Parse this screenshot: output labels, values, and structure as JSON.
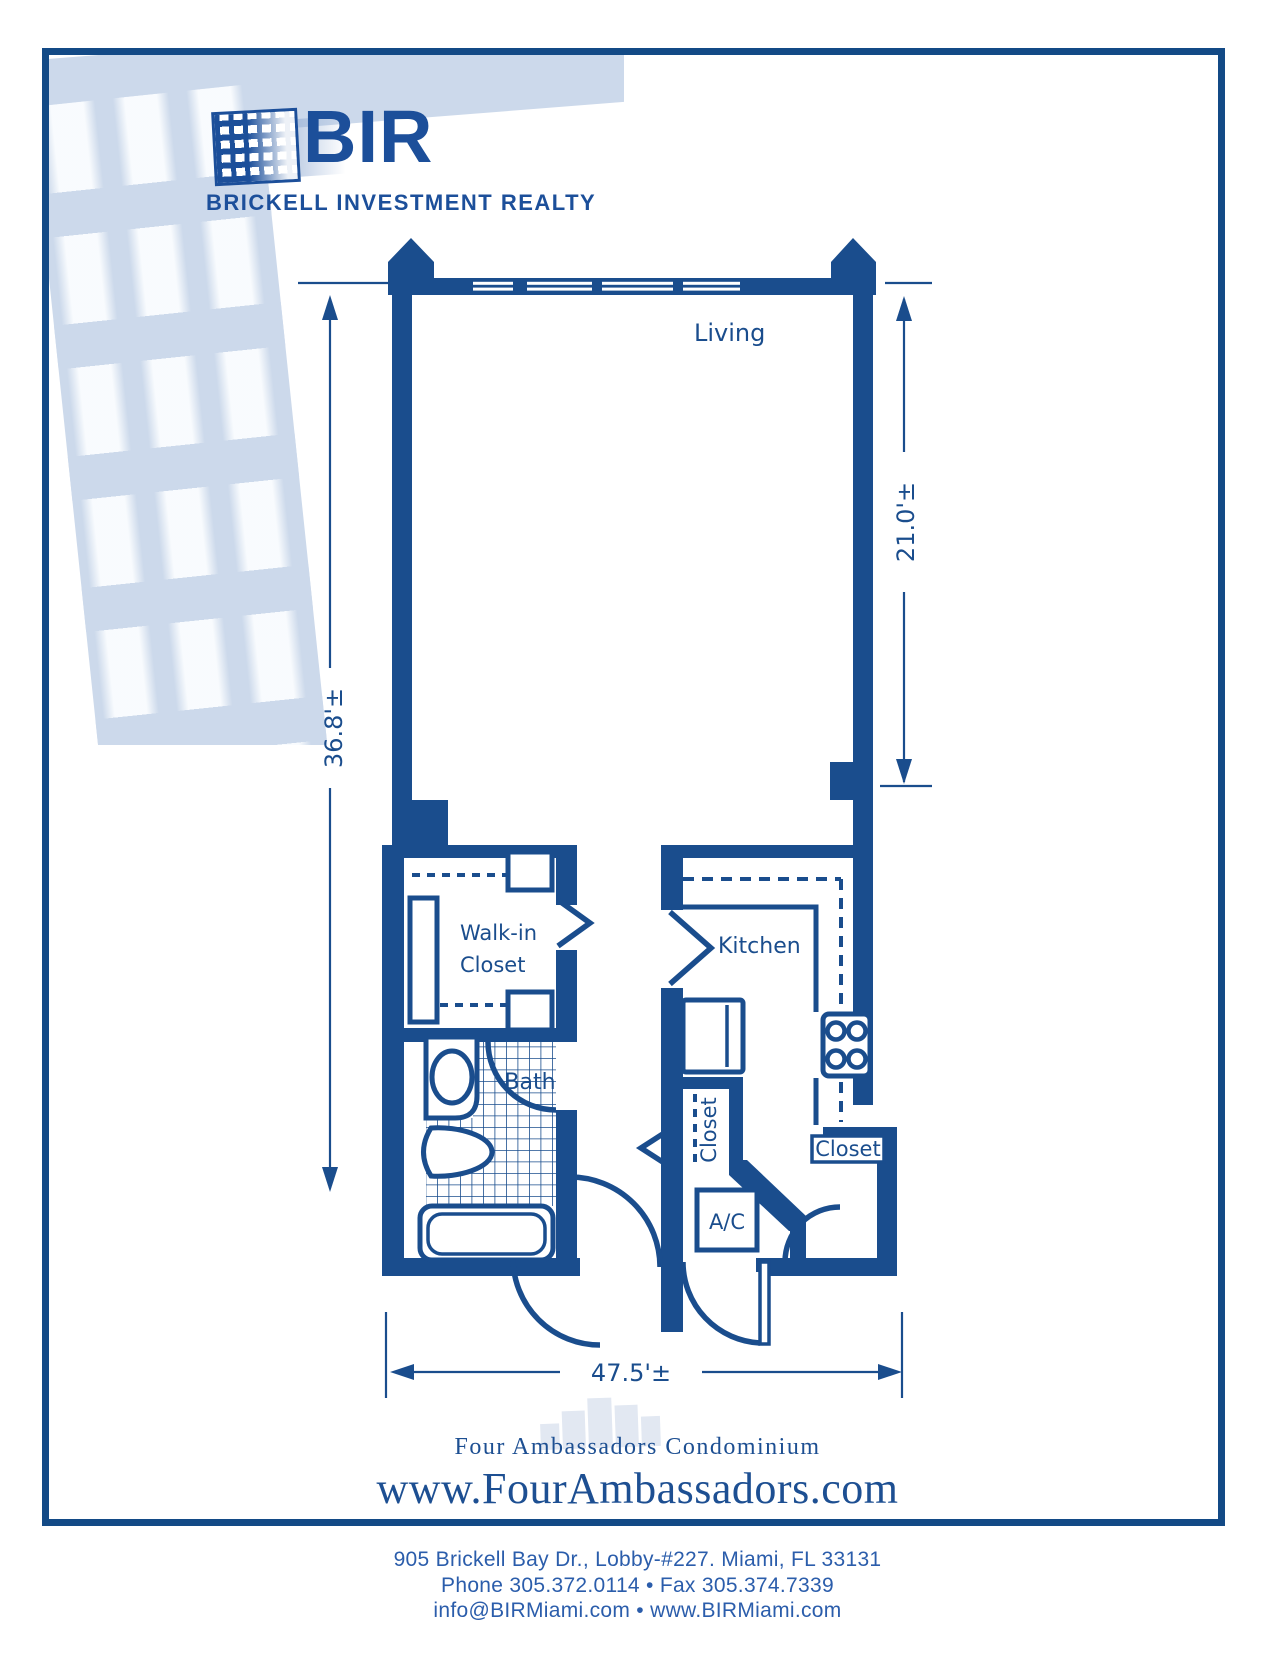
{
  "logo": {
    "name": "BIR",
    "tagline": "BRICKELL INVESTMENT REALTY",
    "icon": "building-windows-icon"
  },
  "plan": {
    "labels": {
      "living": "Living",
      "walk_in_line1": "Walk-in",
      "walk_in_line2": "Closet",
      "kitchen": "Kitchen",
      "bath": "Bath",
      "closet_hall": "Closet",
      "closet_entry": "Closet",
      "ac": "A/C"
    },
    "dimensions": {
      "overall_depth": "36.8'±",
      "living_depth": "21.0'±",
      "overall_width": "47.5'±"
    }
  },
  "footer": {
    "building": "Four Ambassadors Condominium",
    "website": "www.FourAmbassadors.com"
  },
  "contact": {
    "address": "905 Brickell Bay Dr., Lobby-#227. Miami, FL 33131",
    "phone_fax": "Phone  305.372.0114   •   Fax 305.374.7339",
    "email_web": "info@BIRMiami.com • www.BIRMiami.com"
  },
  "colors": {
    "ink": "#1a4d8d",
    "frame": "#134a86",
    "backdrop_light_blue": "#ccd9eb",
    "watermark": "#e2e8f2"
  }
}
